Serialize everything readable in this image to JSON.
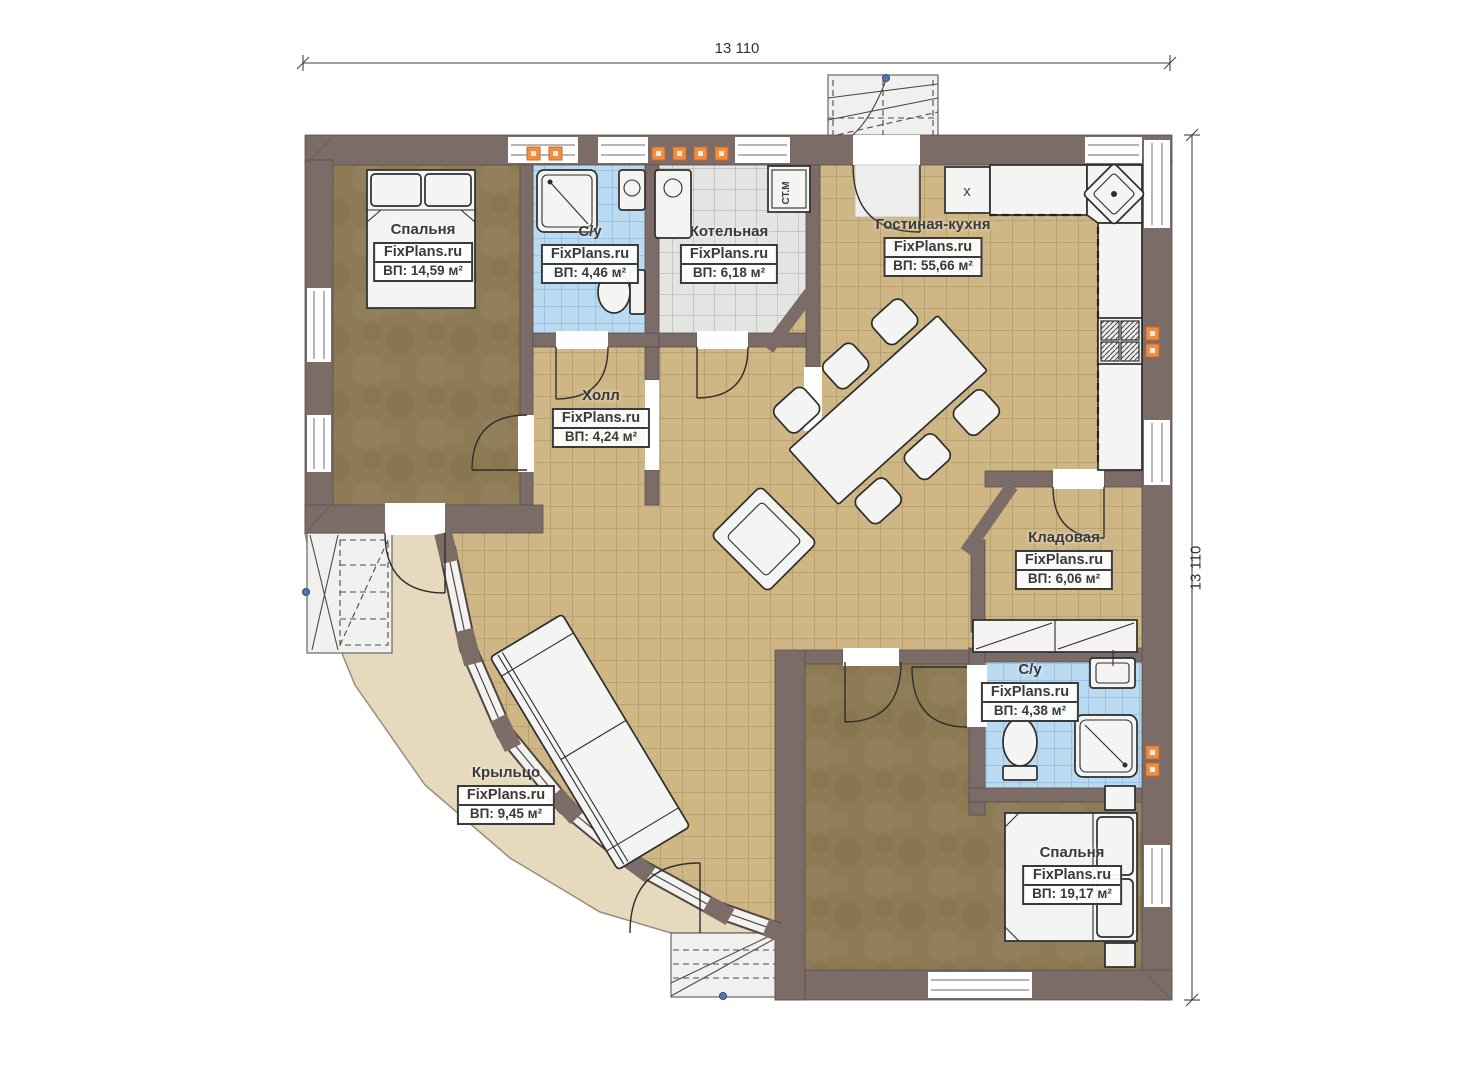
{
  "dimensions": {
    "top": "13 110",
    "right": "13 110"
  },
  "rooms": [
    {
      "id": "bedroom-1",
      "name": "Спальня",
      "brand": "FixPlans.ru",
      "area": "ВП: 14,59 м²"
    },
    {
      "id": "bathroom-1",
      "name": "С/у",
      "brand": "FixPlans.ru",
      "area": "ВП: 4,46 м²"
    },
    {
      "id": "boiler-room",
      "name": "Котельная",
      "brand": "FixPlans.ru",
      "area": "ВП: 6,18 м²"
    },
    {
      "id": "living-kitchen",
      "name": "Гостиная-кухня",
      "brand": "FixPlans.ru",
      "area": "ВП: 55,66 м²"
    },
    {
      "id": "hall",
      "name": "Холл",
      "brand": "FixPlans.ru",
      "area": "ВП: 4,24 м²"
    },
    {
      "id": "storage",
      "name": "Кладовая",
      "brand": "FixPlans.ru",
      "area": "ВП: 6,06 м²"
    },
    {
      "id": "bathroom-2",
      "name": "С/у",
      "brand": "FixPlans.ru",
      "area": "ВП: 4,38 м²"
    },
    {
      "id": "bedroom-2",
      "name": "Спальня",
      "brand": "FixPlans.ru",
      "area": "ВП: 19,17 м²"
    },
    {
      "id": "porch",
      "name": "Крыльцо",
      "brand": "FixPlans.ru",
      "area": "ВП: 9,45 м²"
    }
  ],
  "markers": {
    "washing_machine": "СТ.М",
    "kitchen_appliance": "x"
  },
  "colors": {
    "wall": "#7c6c67",
    "floor_tile_tan": "#cfb685",
    "floor_wood_brown": "#8d7b56",
    "tile_blue": "#badaf2",
    "tile_gray": "#e4e4e2",
    "porch_beige": "#e7d9bd",
    "vent_orange": "#ef8f45"
  }
}
